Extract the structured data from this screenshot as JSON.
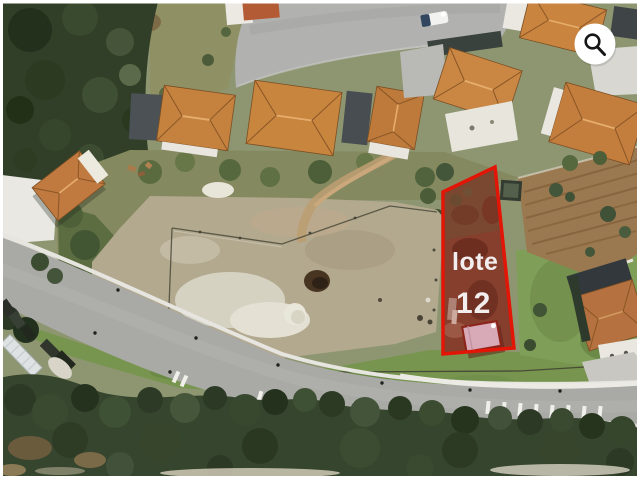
{
  "photo": {
    "description": "Aerial satellite photo of a residential street with terracotta-roof houses, a cleared dirt field, roads and trees"
  },
  "plot_overlay": {
    "label_line1": "lote",
    "label_line2": "12",
    "outline_color": "#e21506",
    "fill_tint": "#c11c0e",
    "label_color": "#f3eeee"
  },
  "zoom_button": {
    "icon": "search-icon",
    "background_color": "#ffffff",
    "glyph_color": "#161616"
  }
}
